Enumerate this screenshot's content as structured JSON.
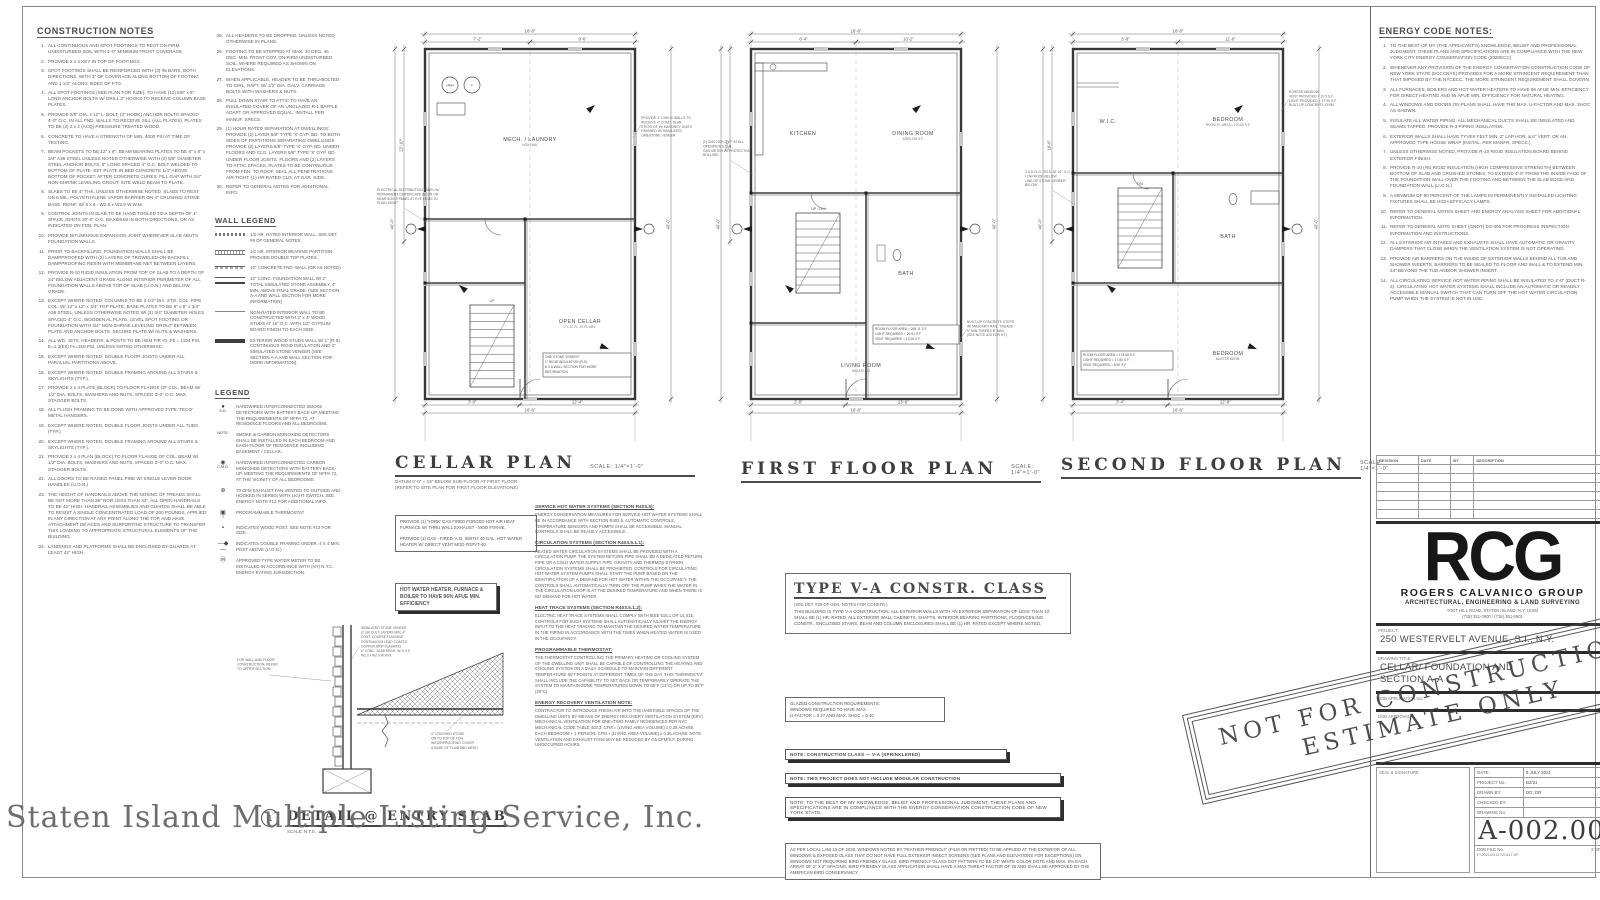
{
  "watermark": "Staten Island Multiple Listing Service, Inc.",
  "construction_notes": {
    "title": "CONSTRUCTION NOTES",
    "items": [
      "ALL CONTINUOUS AND SPOT FOOTINGS TO REST ON FIRM UNDISTURBED SOIL WITH 4'-0\" MINIMUM FROST COVERAGE.",
      "PROVIDE 2 x 4 KEY IN TOP OF FOOTINGS.",
      "SPOT FOOTINGS SHALL BE REINFORCED WITH (3) #5 BARS, BOTH DIRECTIONS, WITH 3\" OF COVERAGE ALONG BOTTOM OF FOOTING AND 1 1/2\" ALONG SIDES OF FTG.",
      "ALL SPOT FOOTINGS (SEE PLAN FOR SIZE), TO HAVE (12) 5/8\" x 8\" LONG ANCHOR BOLTS W/ DRILL 3\" HOOKS TO RECEIVE COLUMN BASE PLATES.",
      "PROVIDE 5/8\" DIA. x 12\" L. BOLT, (3\" HOOK) ANCHOR BOLTS SPACED 4'-0\" O.C. IN ALL FND. WALLS TO RECEIVE SILL (ALL PLATES). PLATES TO BE (2) 2 x 4 (ACQ) PRESSURE TREATED WOOD.",
      "CONCRETE TO HAVE A STRENGTH OF MIN. 4000 PSI AT TIME OF TESTING.",
      "BEAM POCKETS TO BE 12\" x 8\". BEAM BEARING PLATES TO BE 8\" x 8\" x 3/4\" A36 STEEL UNLESS NOTED OTHERWISE WITH (2) 5/8\" DIAMETER STEEL ANCHOR BOLTS, 8\" LONG SPACED 4\" O.C. BOLT WELDED TO BOTTOM OF PLATE. SET PLATE IN BED CONCRETE 1/4\" ABOVE BOTTOM OF POCKET. AFTER CONCRETE CURES, FILL GAP WITH 3/4\" NON-SHRINK LEVELING GROUT. SITE WELD BEAM TO PLATE.",
      "SLABS TO BE 4\" THK. UNLESS OTHERWISE NOTED. SLABS TO REST ON 6 MIL. POLYETHYLENE VAPOR BARRIER ON 4\" CRUSHED STONE BASE. REINF. W/ 6 x 6 - W2.9 x W2.9 W.W.M.",
      "CONTROL JOINTS IN SLAB TO BE HAND TOOLED TO A DEPTH OF 1\". SPACE JOINTS 20'-0\" O.C. MAXIMUM IN BOTH DIRECTIONS, OR AS INDICATED ON FDN. PLAN.",
      "PROVIDE BITUMINOUS EXPANSION JOINT WHEREVER SLAB ABUTS FOUNDATION WALLS.",
      "PRIOR TO BACKFILLING, FOUNDATION WALLS SHALL BE DAMPPROOFED WITH (2) LAYERS OF TROWELED-ON BACKFILL DAMPPROOFING RESIN WITH MEMBRANE NET BETWEEN LAYERS.",
      "PROVIDE R-10 RIGID INSULATION FROM TOP OF SLAB TO A DEPTH OF 24\" BELOW ADJACENT GRADE ALONG INTERIOR PERIMETER OF ALL FOUNDATION WALLS ABOVE TOP OF SLAB (U.O.N.) AND BELOW GRADE.",
      "EXCEPT WHERE NOTED, COLUMNS TO BE 3 1/2\" DIA. STD. COL. PIPE COL. W/ 12\" x 12\" x 3/4\" TOP PLATE, BASE PLATES TO BE 8\" x 8\" x 3/4\" A36 STEEL, UNLESS OTHERWISE NOTED W/ (2) 3/4\" DIAMETER HOLES SPACED 4\" O.C. WOODEN AL PLATE. LEVEL SPOT FOOTING OR FOUNDATION WITH 3/4\" NON-SHRINK LEVELING GROUT BETWEEN PLATE AND ANCHOR BOLTS. SECURE PLATE W/ NUTS & WASHERS.",
      "ALL WD. JSTS, HEADERS, & POSTS TO BE HEM FIR #2, Fb = 1104 PSI, E=1.3(E6) Fv=150 PSI, UNLESS NOTED OTHERWISE.",
      "EXCEPT WHERE NOTED, DOUBLE FLOOR JOISTS UNDER ALL PARALLEL PARTITIONS ABOVE.",
      "EXCEPT WHERE NOTED, DOUBLE FRAMING AROUND ALL STAIRS & SKYLIGHTS (TYP.).",
      "PROVIDE 2 x 4 PLATE (BLOCK) TO FLOOR FLANGE OF COL. BEAM W/ 1/2\" DIA. BOLTS, WASHERS AND NUTS, SPACED 3'-0\" O.C. MAX. STAGGER BOLTS.",
      "ALL FLUSH FRAMING TO BE DONE WITH APPROVED TYPE 'TECO' METAL HANGERS.",
      "EXCEPT WHERE NOTED, DOUBLE FLOOR JOISTS UNDER ALL TUBS (TYP.).",
      "EXCEPT WHERE NOTED, DOUBLE FRAMING AROUND ALL STAIRS & SKYLIGHTS (TYP.).",
      "PROVIDE 2 x 4 PLAN (BLOCK) TO FLOOR FLANGE OF COL. BEAM W/ 1/2\" DIA. BOLTS, WASHERS AND NUTS, SPACED 3'-0\" O.C. MAX. STAGGER BOLTS.",
      "ALL DOORS TO BE RAISED PANEL PINE W/ SINGLE LEVER DOOR HANDLES (U.O.N.)",
      "THE HEIGHT OF HANDRAILS ABOVE THE NOSING OF TREADS SHALL BE NOT MORE THAN 38\" NOR LESS THAN 34\". ALL OPEN HANDRAILS TO BE 42\" HIGH. HANDRAIL ASSEMBLIES AND GUARDS SHALL BE ABLE TO RESIST A SINGLE CONCENTRATED LOAD OF 200 POUNDS, APPLIED IN ANY DIRECTION AT ANY POINT ALONG THE TOP, AND HAVE ATTACHMENT DEVICES AND SUPPORTING STRUCTURE TO TRANSFER THIS LOADING TO APPROPRIATE STRUCTURAL ELEMENTS OF THE BUILDING.",
      "LANDINGS AND PLATFORMS SHALL BE ENCLOSED BY GUARDS AT LEAST 42\" HIGH."
    ],
    "items2": [
      "ALL HEADERS TO BE DROPPED, UNLESS NOTED OTHERWISE IN PLANS.",
      "FOOTING TO BE STEPPED AT MAX. 30 DEG. 45 DEG. MIN. FROST COV. ON FIRM UNDISTURBED SOIL, WHERE REQUIRED AS SHOWN ON ELEVATIONS.",
      "WHEN APPLICABLE, HEADER TO BE THRU-BOLTED TO GIRL, RAFT. W/ 1/2\" DIA. GALV. CARRIAGE BOLTS WITH WASHERS & NUTS.",
      "PULL DOWN STAIR TO ATTIC TO HAVE AN INSULATED COVER OF AN UNGLAZED R-1 BAFFLE ADAPT OR APPROVED EQUAL. INSTALL PER MANUF. SPECS.",
      "(1) HOUR RATED SEPARATION AT DWELLINGS: PROVIDE (2) LAYER 5/8\" TYPE 'X' GYP. BD. TO BOTH SIDES OF PARTITIONS SEPARATING DWELLINGS PROVIDE (2) LAYERS 5/8\" TYPE 'X' GYP. BD. UNDER FLOORS AND CLG. LAYERS 5/8\" TYPE 'X' GYP. BD. UNDER FLOOR JOISTS. FLOORS AND (2) LAYERS TO ATTIC SPACES. PLATES TO BE CONTINUOUS FROM FDN. TO ROOF. SEAL ALL PENETRATIONS AIR-TIGHT. (1) HR RATED CLG. AT GAR. SIDE.",
      "REFER TO GENERAL NOTES FOR ADDITIONAL INFO."
    ]
  },
  "wall_legend": {
    "title": "WALL LEGEND",
    "items": [
      {
        "sym": "sym-a",
        "text": "1/2 HR. RATED INTERIOR WALL. SEE DET. #8 OF GENERAL NOTES."
      },
      {
        "sym": "sym-b",
        "text": "1/2 HR. INTERIOR BEARING PARTITION. PROVIDE DOUBLE TOP PLATES."
      },
      {
        "sym": "sym-c",
        "text": "10\" CONCRETE FND. WALL (OR AS NOTED)"
      },
      {
        "sym": "sym-d",
        "text": "10\" CONC. FOUNDATION WALL W/ 2\" TOTAL SIMULATED STONE ASSEMBLY, 4\" MIN. ABOVE FINAL GRADE. (SEE SECTION A-A AND WALL SECTION FOR MORE INFORMATION)"
      },
      {
        "sym": "sym-e",
        "text": "NON-RATED INTERIOR WALL TO BE CONSTRUCTED WITH 2\" x 4\" WOOD STUDS AT 16\" O.C. WITH 1/2\" GYPSUM BOARD FINISH TO EACH SIDE."
      },
      {
        "sym": "sym-f",
        "text": "EXTERIOR WOOD STUDS WALL W/ 1\" (R-5) CONTINUOUS RIGID INSULATION AND 2\" SIMULATED STONE VENEER (SEE SECTION A-A AND WALL SECTION FOR MORE INFORMATION)."
      }
    ]
  },
  "legend": {
    "title": "LEGEND",
    "items": [
      {
        "sym": "●",
        "label": "S.D.",
        "text": "HARDWIRED INTERCONNECTED SMOKE DETECTORS WITH BATTERY BACK-UP, MEETING THE REQUIREMENTS OF NFPA 72, AT RESIDENCE FLOORS AND ALL BEDROOMS."
      },
      {
        "sym": "",
        "label": "NOTE:",
        "text": "SMOKE & CARBON MONOXIDE DETECTORS SHALL BE INSTALLED IN EACH BEDROOM AND EACH FLOOR OF RESIDENCE INCLUDING BASEMENT / CELLAR."
      },
      {
        "sym": "◉",
        "label": "C.M.D.",
        "text": "HARDWIRED INTERCONNECTED CARBON MONOXIDE DETECTORS WITH BATTERY BACK-UP, MEETING THE REQUIREMENTS OF NFPA 72, AT THE VICINITY OF ALL BEDROOMS."
      },
      {
        "sym": "⊕",
        "label": "",
        "text": "70 CFM EXHAUST FAN VENTED TO OUTSIDE AND HOOKED IN SERIES WITH LIGHT SWITCH. SEE ENERGY NOTE #12 FOR ADDITIONAL INFO."
      },
      {
        "sym": "▣",
        "label": "T",
        "text": "PROGRAMMABLE THERMOSTAT"
      },
      {
        "sym": "▪",
        "label": "",
        "text": "INDICATES WOOD POST. SEE NOTE #13 FOR SIZE."
      },
      {
        "sym": "—◆—",
        "label": "",
        "text": "INDICATES DOUBLE FRAMING UNDER. 4 X 4 MIN. POST ABOVE (U.O.N.)"
      },
      {
        "sym": "Ⓜ",
        "label": "",
        "text": "APPROVED TYPE WATER METER TO BE INSTALLED IN ACCORDANCE WITH (NY) N.Y.C. ENERGY RATING JURISDICTION."
      }
    ]
  },
  "plans": [
    {
      "title": "CELLAR PLAN",
      "scale": "SCALE: 1/4\"=1'-0\"",
      "note1": "DATUM 0'-0\" = 15\" BELOW SUB-FLOOR AT FIRST FLOOR",
      "note2": "(REFER TO SITE PLAN FOR FIRST FLOOR ELEVATIONS)",
      "rooms": [
        "MECH. / LAUNDRY",
        "OPEN CELLAR"
      ],
      "room_subs": [
        "NON HAB.",
        "2 X 10 FL. JSTS. ABV."
      ],
      "stair_label": "UP",
      "dims": {
        "top": "16'-8\"",
        "bottom": "16'-8\"",
        "left": "40'-0\"",
        "right": "40'-0\""
      },
      "microdims": [
        "7'-2\"",
        "9'-6\"",
        "12'-4\"",
        "3'-0\"",
        "22'-10\""
      ],
      "annos_left": [
        "ELECTRICAL DISTRIBUTION PANEL W/",
        "PERMANENT CERTIFICATE IN, ON OR",
        "NEAR 6/2019 PANEL AT EYE LEVEL IN",
        "PLAIN SIGHT"
      ],
      "annos_right": [
        "PROVIDE 4\" CHECK WALLS TO",
        "RECEIVE 4\" CONC. SLAB",
        "STEPS OF W/ MASONRY UNITS",
        "FINISHED W/ SIMULATED",
        "LIMESTONE VENEER"
      ],
      "area_box": [
        "ONE STONE VENEER",
        "1\" RIGID INSULATION (R-5)",
        "6 X 6 WALL SECTION FOR MORE",
        "INFORMATION"
      ]
    },
    {
      "title": "FIRST FLOOR PLAN",
      "scale": "SCALE: 1/4\"=1'-0\"",
      "note1": "",
      "note2": "",
      "rooms": [
        "KITCHEN",
        "DINING ROOM",
        "LIVING ROOM",
        "BATH"
      ],
      "room_subs": [
        "",
        "AREA 196 S.F.",
        "AREA FL. 12",
        ""
      ],
      "stair_label": "UP / DN",
      "dims": {
        "top": "16'-8\"",
        "bottom": "16'-8\"",
        "left": "40'-0\"",
        "right": "40'-0\""
      },
      "microdims": [
        "6'-4\"",
        "10'-2\"",
        "13'-6\"",
        "2'-8\"",
        "21'-0\""
      ],
      "annos_left": [
        "(2) 2x10 HDR. TYP. AT ALL",
        "OPENINGS U.O.N.",
        "GAS METER W/ PROTECTIVE",
        "BOLLARD"
      ],
      "annos_right": [
        "BUILT-UP CONCRETE STEPS",
        "W/ MASONRY RAIL. TREADS",
        "9\" MIN. RISERS 8\" MAX.",
        "(SEE NOTE #23 FOR HT.)"
      ],
      "area_box": [
        "ROOM FLOOR AREA = 265.11 S.F.",
        "LIGHT REQUIRED = 26.51 S.F.",
        "VENT REQUIRED = 13.25 S.F."
      ]
    },
    {
      "title": "SECOND FLOOR PLAN",
      "scale": "SCALE: 1/4\"=1'-0\"",
      "note1": "",
      "note2": "",
      "rooms": [
        "BEDROOM",
        "BATH",
        "BEDROOM",
        "W.I.C."
      ],
      "room_subs": [
        "ROOM FL. AREA = 120.60 S.F.",
        "",
        "MASTER BDRM.",
        ""
      ],
      "stair_label": "DN",
      "dims": {
        "top": "16'-8\"",
        "bottom": "16'-8\"",
        "left": "40'-0\"",
        "right": "40'-0\""
      },
      "microdims": [
        "5'-8\"",
        "11'-0\"",
        "12'-8\"",
        "3'-4\"",
        "19'-6\""
      ],
      "annos_left": [
        "2 X 8 CLG. JSTS. AT 16\" O.C.",
        "LOW ROOF BELOW",
        "LINE OF STONE VENEER",
        "BELOW"
      ],
      "annos_right": [
        "EGRESS WINDOW",
        "VENT PROVIDED = 10.5 S.F.",
        "LIGHT PROVIDED = 17.90 S.F.",
        "BUILT-UP CONCRETE CHIM."
      ],
      "area_box": [
        "ROOM FLOOR AREA = 178.08 S.F.",
        "LIGHT REQUIRED = 17.80 S.F.",
        "VENT REQUIRED = 8.90 S.F."
      ]
    }
  ],
  "mech_box1": "PROVIDE (1) 'YORK' GAS FIRED FORCED HOT AIR HEAT FURNACE W/ THRU WALL EXHAUST - MOD #TM-9E.\n\nPROVIDE (1) GAS - FIRED 'A.O. SMITH' 40 GAL. HOT WATER HEATER W/ DIRECT VENT MOD #GPVT-40.",
  "mech_box2": "HOT WATER HEATER, FURNACE & BOILER TO HAVE 96% AFUE MIN. EFFICIENCY",
  "center_paragraphs": [
    {
      "h": "SERVICE HOT WATER SYSTEMS (SECTION R403.5):",
      "body": "ENERGY CONSERVATION MEASURES FOR SERVICE HOT WATER SYSTEMS SHALL BE IN ACCORDANCE WITH SECTION R403.5. AUTOMATIC CONTROLS, TEMPERATURE SENSORS AND PUMPS SHALL BE ACCESSIBLE. MANUAL CONTROLS SHALL BE READILY ACCESSIBLE."
    },
    {
      "h": "CIRCULATION SYSTEMS (SECTION R403.5.1.1):",
      "body": "HEATED WATER CIRCULATION SYSTEMS SHALL BE PROVIDED WITH A CIRCULATION PUMP. THE SYSTEM RETURN PIPE SHALL BE A DEDICATED RETURN PIPE OR A COLD WATER SUPPLY PIPE. GRAVITY AND THERMOS-SYPHON CIRCULATION SYSTEMS SHALL BE PROHIBITED. CONTROLS FOR CIRCULATING HOT WATER SYSTEM PUMPS SHALL START THE PUMP BASED ON THE IDENTIFICATION OF A DEMAND FOR HOT WATER WITHIN THE OCCUPANCY. THE CONTROLS SHALL AUTOMATICALLY TURN OFF THE PUMP WHEN THE WATER IN THE CIRCULATION LOOP IS AT THE DESIRED TEMPERATURE AND WHEN THERE IS NO DEMAND FOR HOT WATER."
    },
    {
      "h": "HEAT TRACE SYSTEMS (SECTION R403.5.1.2):",
      "body": "ELECTRIC HEAT TRACE SYSTEMS SHALL COMPLY WITH IEEE 515.1 OR UL 515. CONTROLS FOR SUCH SYSTEMS SHALL AUTOMATICALLY ADJUST THE ENERGY INPUT TO THE HEAT TRACING TO MAINTAIN THE DESIRED WATER TEMPERATURE IN THE PIPING IN ACCORDANCE WITH THE TIMES WHEN HEATED WATER IS USED IN THE OCCUPANCY."
    },
    {
      "h": "PROGRAMMABLE THERMOSTAT:",
      "body": "THE THERMOSTAT CONTROLLING THE PRIMARY HEATING OR COOLING SYSTEM OF THE DWELLING UNIT SHALL BE CAPABLE OF CONTROLLING THE HEATING AND COOLING SYSTEM ON A DAILY SCHEDULE TO MAINTAIN DIFFERENT TEMPERATURE SET POINTS AT DIFFERENT TIMES OF THE DAY. THIS THERMOSTAT SHALL INCLUDE THE CAPABILITY TO SET BACK OR TEMPORARILY OPERATE THE SYSTEM TO MAINTAIN ZONE TEMPERATURES DOWN TO 55°F (13°C) OR UP TO 85°F (29°C)."
    },
    {
      "h": "ENERGY RECOVERY VENTILATION NOTE:",
      "body": "CONTRACTOR TO INTRODUCE FRESH AIR INTO THE HABITABLE SPACES OF THE DWELLING UNITS BY MEANS OF ENERGY RECOVERY VENTILATION SYSTEM (ERV). MECHANICAL VENTILATION FOR ONE-/TWO-FAMILY RESIDENCES PER NYC MECHANICAL CODE TABLE 403.3. CFM = (LIVING AREA VOLUME) x 0.35 ACH/60. EACH BEDROOM + 1 PERSON. CFM + (LIVING AREA VOLUME) x 0.35 ACH/60. NOTE: VENTILATION AND EXHAUST FANS MAY BE REDUCED BY 0.5 CFM/S.F. DURING UNOCCUPIED HOURS."
    }
  ],
  "type_va": {
    "title": "TYPE V-A CONSTR. CLASS",
    "sub": "(SEE DET. #29 OF GEN. NOTES FOR CONSTR.)",
    "body": "THIS BUILDING IS TYPE V-A CONSTRUCTION. ALL EXTERIOR WALLS WITH AN EXTERIOR SEPARATION OF LESS THAN 10' SHALL BE (1) HR. RATED. ALL EXTERIOR WALL CABINETS, SHAFTS, INTERIOR BEARING PARTITIONS, FLOOR/CEILING CONSTR., ENCLOSED STAIRS, BEAM AND COLUMN ENCLOSURES SHALL BE (1) HR. RATED EXCEPT WHERE NOTED."
  },
  "glazed_box": "GLAZED CONSTRUCTION REQUIREMENTS:\nWINDOWS REQUIRED TO HAVE MAX.\nU-FACTOR = 0.27 AND MAX. SHGC = 0.40",
  "note_bar1": "NOTE: CONSTRUCTION CLASS — V-A (SPRINKLERED)",
  "note_bar2": "NOTE: THIS PROJECT DOES NOT INCLUDE MODULAR CONSTRUCTION",
  "note_bar3": "NOTE: TO THE BEST OF MY KNOWLEDGE, BELIEF AND PROFESSIONAL JUDGMENT, THESE PLANS AND SPECIFICATIONS ARE IN COMPLIANCE WITH THE ENERGY CONSERVATION CONSTRUCTION CODE OF NEW YORK STATE.",
  "bird_box": "AS PER LOCAL LAW 15 OF 2020, WINDOWS NOTED BY 'FEATHER-FRIENDLY' (FILM OR FRITTED) TO BE APPLIED AT THE EXTERIOR OF ALL WINDOWS & EXPOSED GLASS THAT DO NOT HAVE FULL EXTERIOR INSECT SCREENS (SEE PLANS AND ELEVATIONS FOR EXCEPTIONS) ON WINDOWS NOT REQUIRING BIRD FRIENDLY GLASS. BIRD FRIENDLY GLASS DOT PATTERN TO BE 1/4\" WHITE COLOR DOTS AND MAX. 8% EACH ARRAY OF 2\" X 2\" SPACING. BIRD FRIENDLY GLASS APPLICATION SHALL HAVE A MAX THREAT FACTOR OF 25 AND SHALL BE APPROVED BY THE AMERICAN BIRD CONSERVANCY.",
  "detail": {
    "number": "1",
    "title": "DETAIL @ ENTRY SLAB",
    "scale": "SCALE: N.T.S.",
    "annos_left": [
      "FOR WALL AND FLOOR",
      "CONSTRUCTION, REFER",
      "TO UPPER SECTION"
    ],
    "annos_mid": [
      "SIMULATED STONE VENEER",
      "(2 LB) CULT. LAYERS MIN. 4\"",
      "CONT. COURSE FLASHING",
      "CONTINUOUS LEAD COATED",
      "COPPER DRIP FLASHING",
      "6\" CONC. SLAB REINF. W/ 6 X 6",
      "W2.9 x W2.9 W.W.M."
    ],
    "annos_right": [
      "4\" CRUSHED STONE",
      "ON TO TOP OF FDN.",
      "WATERPROOFING COVER",
      "& BASE OF FLASHING MESH"
    ]
  },
  "energy_notes": {
    "title": "ENERGY CODE NOTES:",
    "items": [
      "TO THE BEST OF MY (THE APPLICANT'S) KNOWLEDGE, BELIEF AND PROFESSIONAL JUDGMENT, THESE PLANS AND SPECIFICATIONS ARE IN COMPLIANCE WITH THE NEW YORK CITY ENERGY CONSERVATION CODE (2020ECC).",
      "WHENEVER ANY PROVISION OF THE ENERGY CONSERVATION CONSTRUCTION CODE OF NEW YORK STATE (ECCCNYS) PROVIDES FOR A MORE STRINGENT REQUIREMENT THAN THAT IMPOSED BY THE NYCECC, THE MORE STRINGENT REQUIREMENT SHALL GOVERN.",
      "ALL FURNACES, BOILERS AND HOT WATER HEATERS TO HAVE 96 AFUE MIN. EFFICIENCY FOR DIRECT HEATING AND 95 AFUE MIN. EFFICIENCY FOR NATURAL HEATING.",
      "ALL WINDOWS AND DOORS ON PLANS SHALL HAVE THE MAX. U-FACTOR AND MAX. SHGC AS SHOWN.",
      "INSULATE ALL WATER PIPING. ALL MECHANICAL DUCTS SHALL BE INSULATED AND SEAMS TAPPED. PROVIDE R-3 PIPING INSULATION.",
      "EXTERIOR WALLS SHALL HAVE TYVEK FELT MIN. 2\" LAP HOR. & 6\" VERT. OR AN APPROVED TYPE HOUSE WRAP (INSTAL. PER MANFR. SPECS.)",
      "UNLESS OTHERWISE NOTED, PROVIDE R-10 RIGID INSULATION BOARD BEHIND EXTERIOR FINISH.",
      "PROVIDE R-10 (#5) RIGID INSULATION (HIGH COMPRESSIVE STRENGTH) BETWEEN BOTTOM OF SLAB AND CRUSHED STONES; TO EXTEND 4'-0\" FROM THE INSIDE FACE OF THE FOUNDATION WALL OVER THE FOOTING AND BETWEEN THE SLAB EDGE AND FOUNDATION WALL (U.O.N.)",
      "A MINIMUM OF 90 PERCENT OF THE LAMPS IN PERMANENTLY INSTALLED LIGHTING FIXTURES SHALL BE HIGH-EFFICACY LAMPS.",
      "REFER TO GENERAL NOTES SHEET AND ENERGY ANALYSIS SHEET FOR ADDITIONAL INFORMATION.",
      "REFER TO GENERAL NOTE SHEET (GNOT) DS-005 FOR PROGRESS INSPECTION INFORMATION AND INSTRUCTIONS.",
      "ALL EXTERIOR AIR INTAKES AND EXHAUSTS SHALL HAVE AUTOMATIC OR GRAVITY DAMPERS THAT CLOSE WHEN THE VENTILATION SYSTEM IS NOT OPERATING.",
      "PROVIDE AIR BARRIERS ON THE INSIDE OF EXTERIOR WALLS BEHIND ALL TUB AND SHOWER INSERTS. BARRIERS TO BE SEALED TO FLOOR AND WALL & TO EXTEND MIN. 24\" BEYOND THE TUB AND/OR SHOWER INSERT.",
      "ALL CIRCULATING SERVICE HOT WATER PIPING SHALL BE INSULATED TO 4'-0\" (DUCT R-3). CIRCULATING HOT WATER SYSTEMS SHALL INCLUDE AN AUTOMATIC OR READILY ACCESSIBLE MANUAL SWITCH THAT CAN TURN OFF THE HOT WATER CIRCULATION PUMP WHEN THE SYSTEM IS NOT IN USE."
    ]
  },
  "titleblock": {
    "revision_headers": [
      "REVISION",
      "DATE",
      "BY",
      "DESCRIPTION"
    ],
    "logo": "RCG",
    "firm": "ROGERS CALVANICO GROUP",
    "firm_sub": "ARCHITECTURAL, ENGINEERING & LAND SURVEYING",
    "firm_addr": "TODT HILL ROAD, STATEN ISLAND, N.Y. 10304\n(718) 351-0900 / (718) 351-0901",
    "project_label": "PROJECT:",
    "project": "250 WESTERVELT AVENUE, S.I., N.Y.",
    "drawing_title_label": "DRAWING TITLE:",
    "drawing_title": "CELLAR/ FOUNDATION AND\nSECTION A-A",
    "dob_app_label": "DOB APPLICATION No.:",
    "dob_approval_label": "DOB APPROVAL:",
    "seal_label": "SEAL & SIGNATURE",
    "fields": [
      {
        "label": "DATE:",
        "value": "5 JULY 2021"
      },
      {
        "label": "PROJECT No.:",
        "value": "B2/21"
      },
      {
        "label": "DRAWN BY:",
        "value": "DG, DR"
      },
      {
        "label": "CHECKED BY:",
        "value": ""
      },
      {
        "label": "DRAWING No.",
        "value": ""
      }
    ],
    "drawing_no": "A-002.00",
    "dob_file_label": "DOB FILE No.",
    "sheet_of": "2 OF 11",
    "file_path": "F:\\2021\\20117\\20117 AP"
  },
  "stamp": {
    "line1": "NOT FOR CONSTRUCTION",
    "line2": "ESTIMATE ONLY"
  }
}
